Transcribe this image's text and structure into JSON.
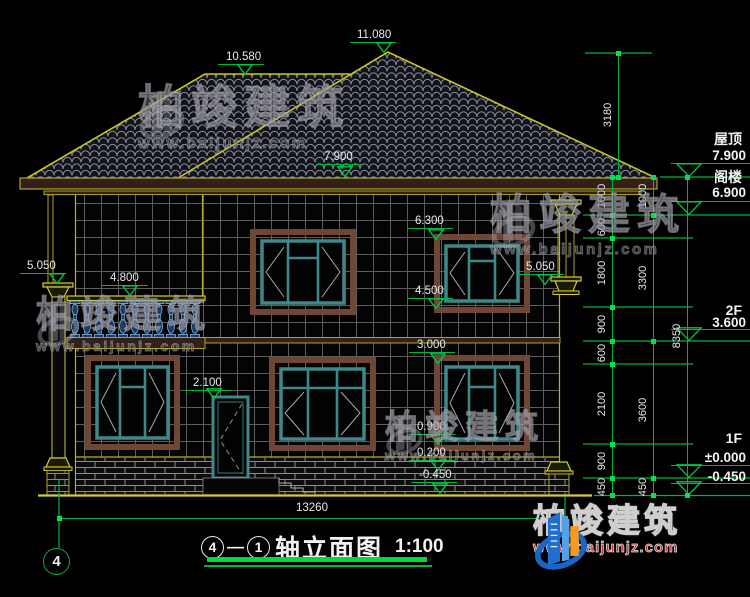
{
  "colors": {
    "background": "#000000",
    "cad_green": "#00b43e",
    "cad_yellow": "#c9c32e",
    "cad_white": "#e9e9e9",
    "fascia_brown": "#33201b",
    "window_frame_brown": "#6e4636",
    "window_frame_teal": "#3e8889",
    "baluster_blue": "#7fb0e0",
    "logo_blue": "#1766c8",
    "logo_orange": "#f59a23",
    "logo_red": "#c23131"
  },
  "watermark": {
    "brand": "柏竣建筑",
    "url": "www.baijunjz.com"
  },
  "watermarks": [
    {
      "x": 138,
      "y": 84,
      "brand_size": 46,
      "url_size": 15,
      "icon_h": 62
    },
    {
      "x": 490,
      "y": 194,
      "brand_size": 42,
      "url_size": 15,
      "icon_h": 60
    },
    {
      "x": 36,
      "y": 296,
      "brand_size": 37,
      "url_size": 14,
      "icon_h": 56
    },
    {
      "x": 385,
      "y": 410,
      "brand_size": 33,
      "url_size": 13,
      "icon_h": 50
    }
  ],
  "elevation_markers": [
    {
      "label": "10.580",
      "tx": 226,
      "ty": 52,
      "lx1": 218,
      "lx2": 264,
      "ly": 64,
      "tipx": 245,
      "tipy": 75
    },
    {
      "label": "11.080",
      "tx": 357,
      "ty": 30,
      "lx1": 350,
      "lx2": 396,
      "ly": 42,
      "tipx": 384,
      "tipy": 53
    },
    {
      "label": "7.900",
      "tx": 324,
      "ty": 152,
      "lx1": 316,
      "lx2": 362,
      "ly": 164,
      "tipx": 345,
      "tipy": 177
    },
    {
      "label": "6.300",
      "tx": 415,
      "ty": 216,
      "lx1": 407,
      "lx2": 453,
      "ly": 228,
      "tipx": 436,
      "tipy": 240
    },
    {
      "label": "4.500",
      "tx": 415,
      "ty": 286,
      "lx1": 407,
      "lx2": 453,
      "ly": 298,
      "tipx": 436,
      "tipy": 309
    },
    {
      "label": "3.000",
      "tx": 417,
      "ty": 340,
      "lx1": 409,
      "lx2": 455,
      "ly": 352,
      "tipx": 438,
      "tipy": 364
    },
    {
      "label": "2.100",
      "tx": 193,
      "ty": 378,
      "lx1": 185,
      "lx2": 231,
      "ly": 390,
      "tipx": 214,
      "tipy": 399
    },
    {
      "label": "0.900",
      "tx": 417,
      "ty": 422,
      "lx1": 409,
      "lx2": 455,
      "ly": 434,
      "tipx": 438,
      "tipy": 445
    },
    {
      "label": "0.200",
      "tx": 417,
      "ty": 448,
      "lx1": 409,
      "lx2": 455,
      "ly": 460,
      "tipx": 438,
      "tipy": 471
    },
    {
      "label": "-0.450",
      "tx": 419,
      "ty": 470,
      "lx1": 411,
      "lx2": 457,
      "ly": 482,
      "tipx": 440,
      "tipy": 494
    },
    {
      "label": "5.050",
      "tx": 27,
      "ty": 261,
      "lx1": 20,
      "lx2": 66,
      "ly": 273,
      "tipx": 57,
      "tipy": 284
    },
    {
      "label": "4.800",
      "tx": 110,
      "ty": 273,
      "lx1": 102,
      "lx2": 148,
      "ly": 285,
      "tipx": 130,
      "tipy": 296
    },
    {
      "label": "5.050",
      "tx": 526,
      "ty": 262,
      "lx1": 518,
      "lx2": 564,
      "ly": 274,
      "tipx": 545,
      "tipy": 285
    }
  ],
  "floor_flags": [
    {
      "name": "屋顶",
      "value": "7.900",
      "name_y": 132,
      "value_y": 149,
      "line_y": 163,
      "tip_y": 177
    },
    {
      "name": "阁楼",
      "value": "6.900",
      "name_y": 170,
      "value_y": 186,
      "line_y": 201,
      "tip_y": 215
    },
    {
      "name": "2F",
      "value": "3.600",
      "name_y": 303,
      "value_y": 316,
      "line_y": 329,
      "tip_y": 341
    },
    {
      "name": "1F",
      "value": "±0.000",
      "name_y": 431,
      "value_y": 451,
      "line_y": 465,
      "tip_y": 478
    },
    {
      "name": "",
      "value": "-0.450",
      "name_y": 0,
      "value_y": 470,
      "line_y": 483,
      "tip_y": 495
    }
  ],
  "dim_chains": [
    {
      "orient": "v",
      "x": 612,
      "segments": [
        {
          "label": "1000",
          "a": 177,
          "b": 215
        },
        {
          "label": "600",
          "a": 215,
          "b": 238
        },
        {
          "label": "1800",
          "a": 238,
          "b": 307
        },
        {
          "label": "900",
          "a": 307,
          "b": 341
        },
        {
          "label": "600",
          "a": 341,
          "b": 364
        },
        {
          "label": "2100",
          "a": 364,
          "b": 444
        },
        {
          "label": "900",
          "a": 444,
          "b": 478
        },
        {
          "label": "450",
          "a": 478,
          "b": 495
        }
      ]
    },
    {
      "orient": "v",
      "x": 653,
      "segments": [
        {
          "label": "1000",
          "a": 177,
          "b": 215
        },
        {
          "label": "3300",
          "a": 215,
          "b": 341
        },
        {
          "label": "3600",
          "a": 341,
          "b": 478
        },
        {
          "label": "450",
          "a": 478,
          "b": 495
        }
      ]
    },
    {
      "orient": "v",
      "x": 687,
      "segments": [
        {
          "label": "8350",
          "a": 177,
          "b": 495
        }
      ]
    },
    {
      "orient": "v",
      "x": 618,
      "segments": [
        {
          "label": "3180",
          "a": 53,
          "b": 177
        }
      ]
    },
    {
      "orient": "h",
      "y": 518,
      "segments": [
        {
          "label": "13260",
          "a": 59,
          "b": 565
        }
      ]
    }
  ],
  "axis_bubble": {
    "label": "4"
  },
  "title_block": {
    "bubble_start": "4",
    "separator": "—",
    "bubble_end": "1",
    "title": "轴立面图",
    "scale": "1:100"
  },
  "logo": {
    "brand": "柏竣建筑",
    "url": "www.baijunjz.com"
  }
}
